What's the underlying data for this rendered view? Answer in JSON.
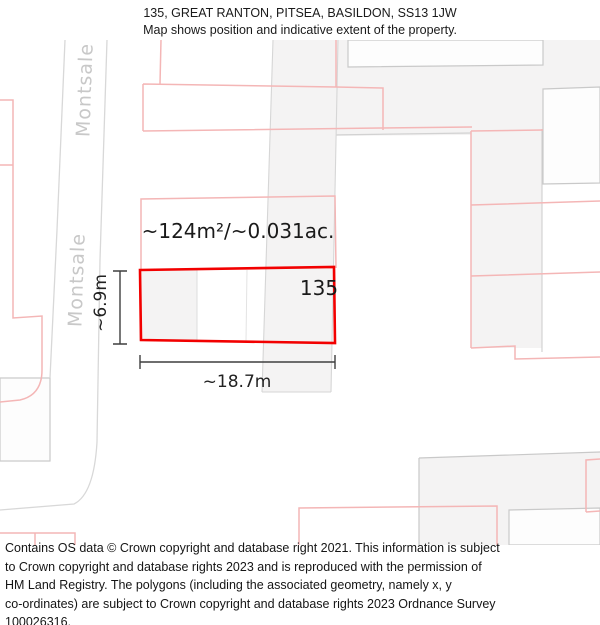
{
  "title": {
    "line1": "135, GREAT RANTON, PITSEA, BASILDON, SS13 1JW",
    "line2": "Map shows position and indicative extent of the property."
  },
  "map": {
    "road_label": "Montsale",
    "area_label": "~124m²/~0.031ac.",
    "plot_number": "135",
    "width_label": "~18.7m",
    "height_label": "~6.9m",
    "colors": {
      "property_highlight_red": "#f20000",
      "parcel_outline_pink": "#f4b6b6",
      "building_fill_gray": "#f4f3f3",
      "map_line_gray": "#d6d6d6",
      "road_label_gray": "#c8c8c8",
      "dimension_line": "#3f3f3f"
    }
  },
  "footer": {
    "lines": [
      "Contains OS data © Crown copyright and database right 2021. This information is subject",
      "to Crown copyright and database rights 2023 and is reproduced with the permission of",
      "HM Land Registry. The polygons (including the associated geometry, namely x, y",
      "co-ordinates) are subject to Crown copyright and database rights 2023 Ordnance Survey",
      "100026316."
    ]
  }
}
